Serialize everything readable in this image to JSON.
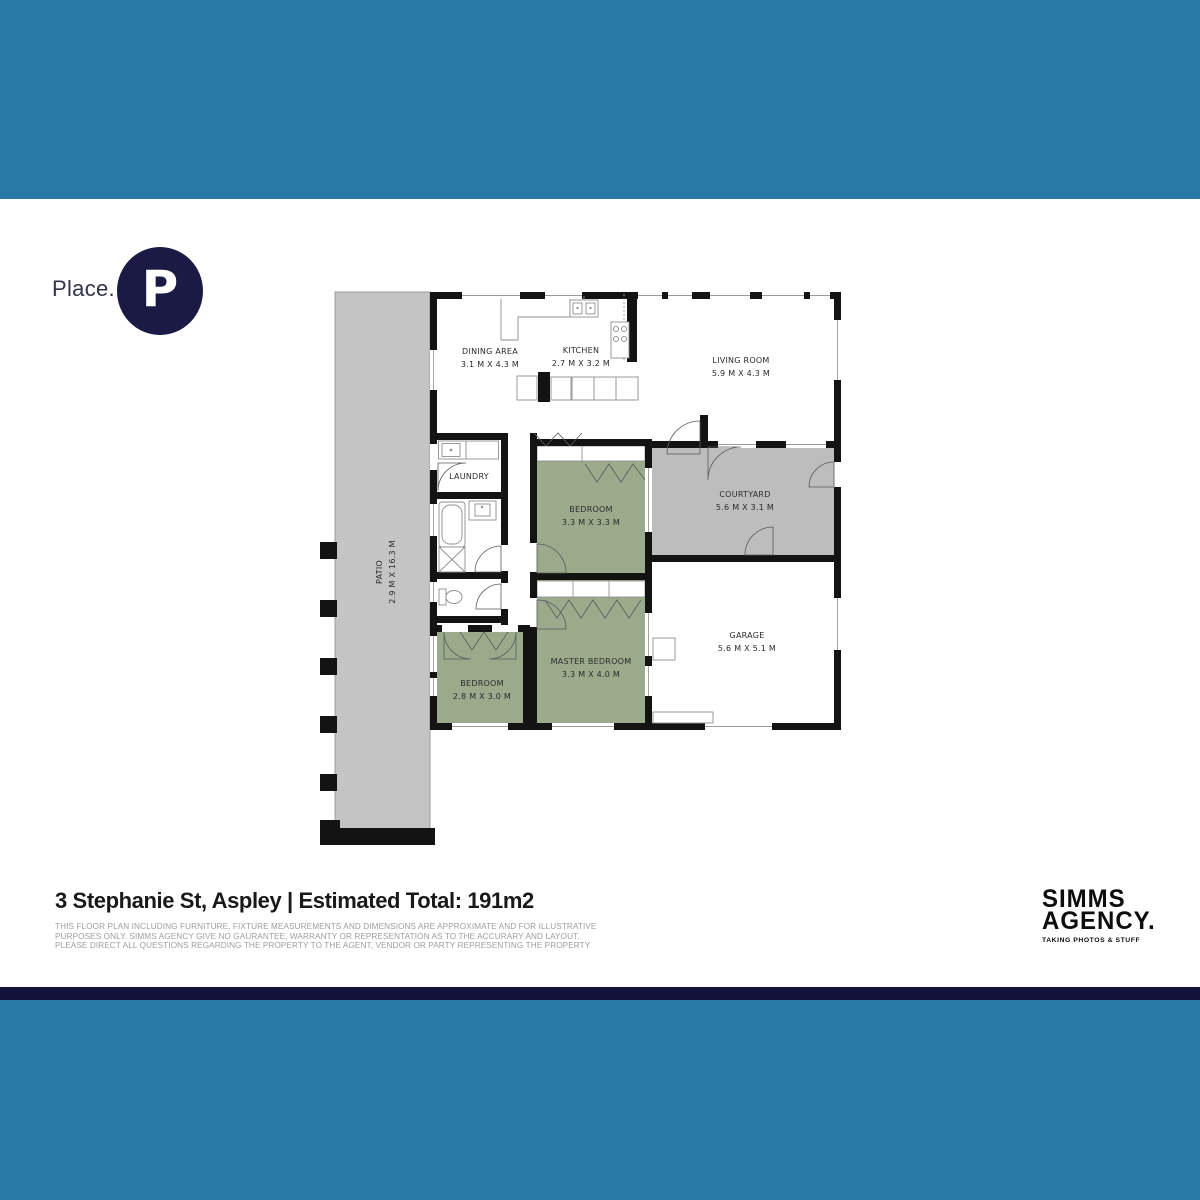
{
  "brand": {
    "wordmark": "Place.",
    "monogram": "P"
  },
  "plan": {
    "rooms": {
      "patio": {
        "name": "PATIO",
        "dims": "2.9 M X 16.3 M"
      },
      "dining": {
        "name": "DINING AREA",
        "dims": "3.1 M X 4.3 M"
      },
      "kitchen": {
        "name": "KITCHEN",
        "dims": "2.7 M X 3.2 M"
      },
      "living": {
        "name": "LIVING ROOM",
        "dims": "5.9 M X 4.3 M"
      },
      "laundry": {
        "name": "LAUNDRY"
      },
      "bedroom1": {
        "name": "BEDROOM",
        "dims": "3.3 M X 3.3 M"
      },
      "courtyard": {
        "name": "COURTYARD",
        "dims": "5.6 M X 3.1 M"
      },
      "garage": {
        "name": "GARAGE",
        "dims": "5.6 M X 5.1 M"
      },
      "master": {
        "name": "MASTER BEDROOM",
        "dims": "3.3 M X 4.0 M"
      },
      "bedroom2": {
        "name": "BEDROOM",
        "dims": "2.8 M X 3.0 M"
      }
    }
  },
  "footer": {
    "title": "3 Stephanie St, Aspley | Estimated Total: 191m2",
    "disclaimer": "THIS FLOOR PLAN INCLUDING FURNITURE, FIXTURE MEASUREMENTS AND DIMENSIONS ARE APPROXIMATE AND FOR ILLUSTRATIVE PURPOSES ONLY. SIMMS AGENCY GIVE NO GAURANTEE, WARRANTY OR REPRESENTATION AS TO THE ACCURARY AND LAYOUT. PLEASE DIRECT ALL QUESTIONS REGARDING THE PROPERTY TO THE AGENT, VENDOR OR PARTY REPRESENTING THE PROPERTY"
  },
  "agency": {
    "name_line1": "SIMMS",
    "name_line2": "AGENCY.",
    "tagline": "TAKING PHOTOS & STUFF"
  },
  "colors": {
    "band": "#2879A4",
    "navy_stripe": "#12123B",
    "logo_navy": "#1A1A45",
    "room_green": "#9BAA8B",
    "patio_gray": "#C4C4C4",
    "courtyard_gray": "#BDBDBD",
    "wall": "#131313"
  }
}
